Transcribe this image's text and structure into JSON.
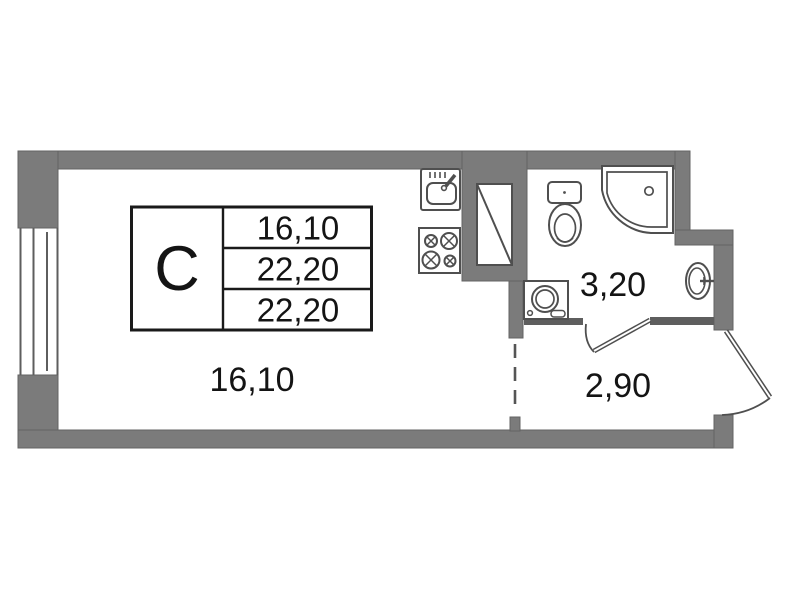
{
  "title": "Studio apartment floor plan",
  "info_table": {
    "unit_type": "С",
    "rows": [
      "16,10",
      "22,20",
      "22,20"
    ]
  },
  "rooms": {
    "living": {
      "area": "16,10"
    },
    "bathroom": {
      "area": "3,20"
    },
    "hallway": {
      "area": "2,90"
    }
  },
  "fixtures": [
    "window-icon",
    "kitchen-sink-icon",
    "stove-icon",
    "ventilation-shaft-icon",
    "toilet-icon",
    "corner-bath-icon",
    "wash-basin-icon",
    "washing-machine-icon",
    "bathroom-door-icon",
    "entry-door-icon",
    "zone-divider-dashed-line"
  ],
  "colors": {
    "wall": "#7b7b7b",
    "wall_edge": "#636363",
    "thin_wall": "#5e5e5e",
    "fixture_stroke": "#4f4f4f",
    "text": "#141414",
    "background": "#ffffff",
    "table_line": "#1a1a1a"
  }
}
